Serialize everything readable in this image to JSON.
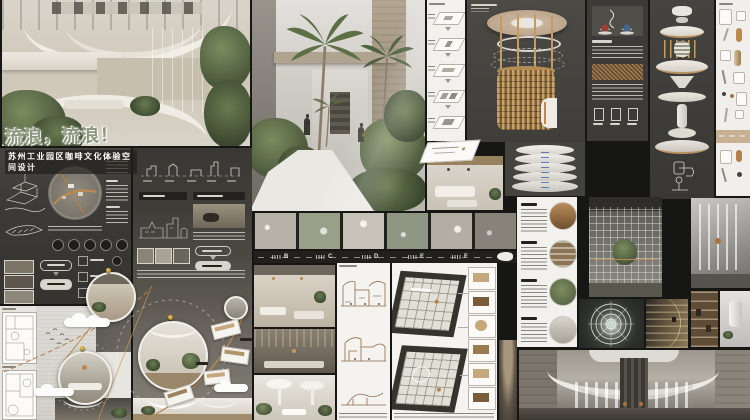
{
  "board": {
    "title": "流浪，流浪！",
    "subtitle": "苏州工业园区咖啡文化体验空间设计"
  },
  "timeline": {
    "markers": [
      "B",
      "C",
      "D",
      "E",
      "F"
    ]
  },
  "colors": {
    "stage_bg": "#161614",
    "board_dark": "#3c3b36",
    "board_darker": "#24231f",
    "paper": "#eceae5",
    "copper": "#bb8a52",
    "title_green": "#8b967c",
    "plant_green": "#67784e",
    "render_beige": "#d6d0c4"
  }
}
